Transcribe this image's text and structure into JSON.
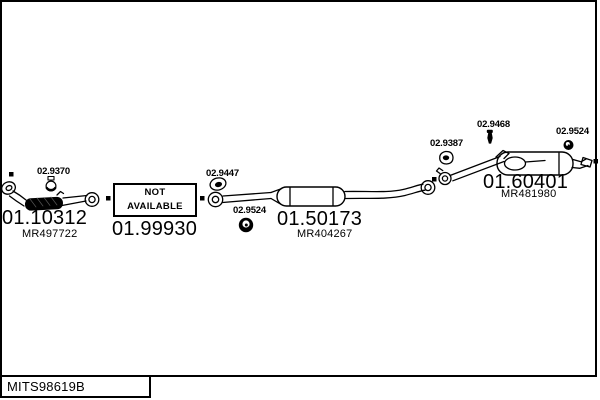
{
  "diagram": {
    "drawing_code": "MITS98619B",
    "colors": {
      "ink": "#000000",
      "paper": "#ffffff"
    }
  },
  "main_parts": [
    {
      "name": "front-pipe",
      "part_number": "01.10312",
      "oem_ref": "MR497722"
    },
    {
      "name": "center-silencer",
      "part_number": "01.50173",
      "oem_ref": "MR404267"
    },
    {
      "name": "rear-silencer",
      "part_number": "01.60401",
      "oem_ref": "MR481980"
    }
  ],
  "unavailable_part": {
    "label_line1": "NOT",
    "label_line2": "AVAILABLE",
    "part_number": "01.99930"
  },
  "accessory_parts": [
    {
      "name": "clamp-front",
      "icon": "clamp-icon",
      "part_number": "02.9370"
    },
    {
      "name": "gasket-center",
      "icon": "gasket-icon",
      "part_number": "02.9447"
    },
    {
      "name": "rubber-mount-center",
      "icon": "rubber-mount-icon",
      "part_number": "02.9524"
    },
    {
      "name": "gasket-rear",
      "icon": "gasket-icon",
      "part_number": "02.9387"
    },
    {
      "name": "bolt-rear",
      "icon": "bolt-icon",
      "part_number": "02.9468"
    },
    {
      "name": "rubber-mount-rear",
      "icon": "rubber-mount-icon",
      "part_number": "02.9524"
    }
  ]
}
